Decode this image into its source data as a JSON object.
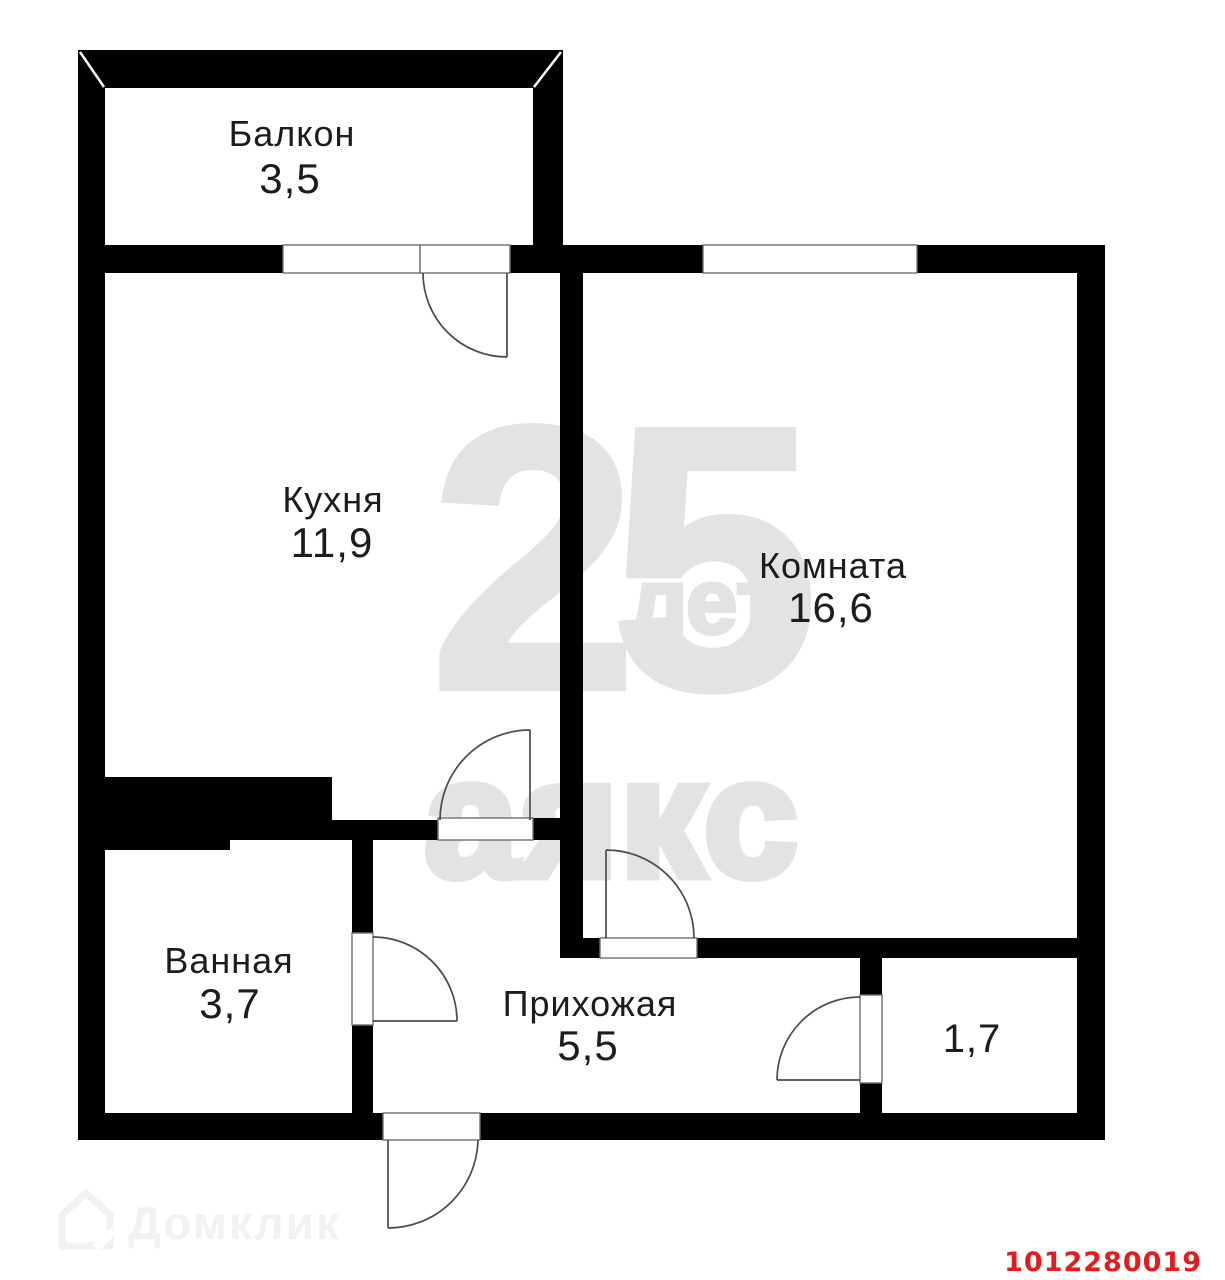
{
  "rooms": {
    "balcony": {
      "name": "Балкон",
      "area": "3,5"
    },
    "kitchen": {
      "name": "Кухня",
      "area": "11,9"
    },
    "room": {
      "name": "Комната",
      "area": "16,6"
    },
    "bathroom": {
      "name": "Ванная",
      "area": "3,7"
    },
    "hallway": {
      "name": "Прихожая",
      "area": "5,5"
    },
    "storage": {
      "area": "1,7"
    }
  },
  "watermarks": {
    "anniversary_number": "25",
    "anniversary_word": "лет",
    "agency": "аякс",
    "portal": "Домклик"
  },
  "listing_id": "1012280019",
  "colors": {
    "walls": "#000000",
    "watermark_gray": "#e3e3e3",
    "portal_watermark": "#f2f2f2",
    "listing_id_red": "#e11d1d"
  }
}
